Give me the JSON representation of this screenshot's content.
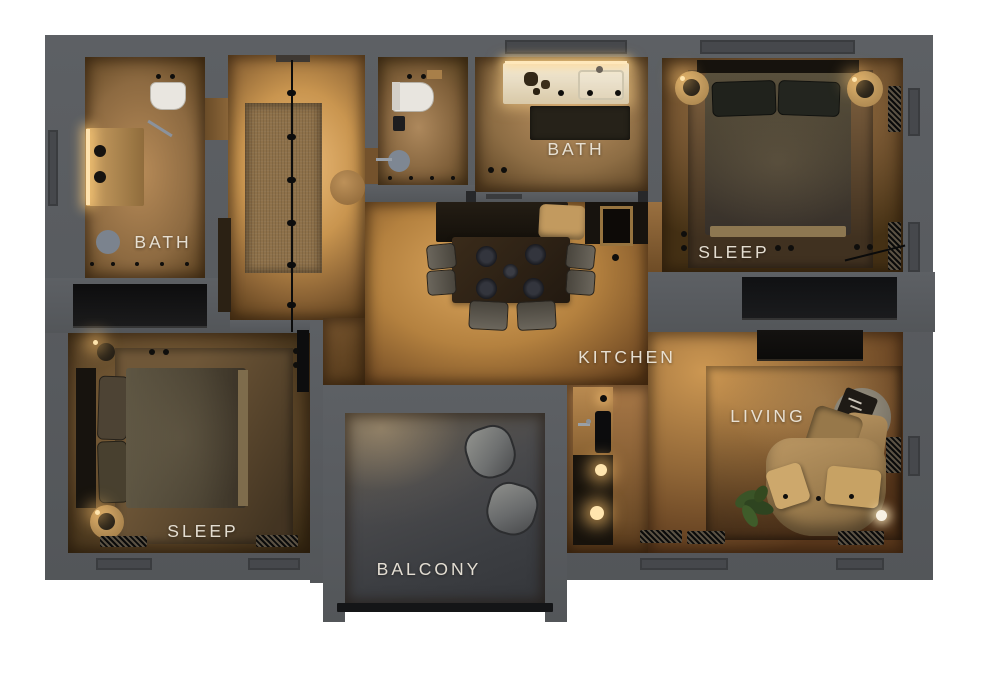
{
  "floorplan": {
    "type": "3d-rendered-apartment-top-view",
    "rooms": [
      {
        "id": "bath-left",
        "label": "BATH",
        "features": [
          "vanity with double sink",
          "toilet",
          "stool",
          "ceiling spots"
        ]
      },
      {
        "id": "bath-main",
        "label": "BATH",
        "features": [
          "lit vanity",
          "sink",
          "shower mat",
          "wc with toilet and round basin"
        ]
      },
      {
        "id": "sleep-right",
        "label": "SLEEP",
        "features": [
          "double bed",
          "two round nightstands with lamps",
          "rug",
          "black wardrobe",
          "radiators"
        ]
      },
      {
        "id": "kitchen",
        "label": "KITCHEN",
        "features": [
          "dining table with four place settings",
          "six chairs",
          "bench with cushion",
          "counter with sink and stove lights"
        ]
      },
      {
        "id": "living",
        "label": "LIVING",
        "features": [
          "curved sofa with pillows and throw",
          "round coffee tables with tray",
          "plant",
          "tv console",
          "glow lamp",
          "rug"
        ]
      },
      {
        "id": "sleep-left",
        "label": "SLEEP",
        "features": [
          "double bed",
          "two round nightstands with lamps",
          "rug",
          "tv panel",
          "radiators"
        ]
      },
      {
        "id": "balcony",
        "label": "BALCONY",
        "features": [
          "two lounge chairs",
          "railing"
        ]
      }
    ],
    "colors": {
      "background": "#ffffff",
      "wall": "#595c5f",
      "wood_bright": "#e2ac6a",
      "wood_mid": "#b07e42",
      "wood_dim": "#6e4d2c",
      "rug_brown": "#8e714a",
      "balcony_floor": "#3e4145",
      "furniture_dark": "#15110d",
      "sofa_tan": "#b6935d",
      "label_text": "#ece6da",
      "lamp_glow": "#ffe5ae"
    }
  }
}
